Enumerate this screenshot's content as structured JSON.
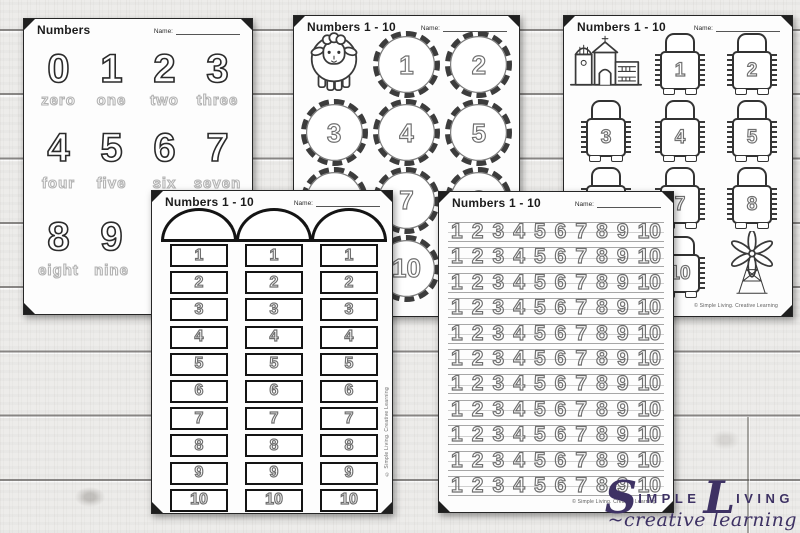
{
  "colors": {
    "logo_purple": "#3e3264",
    "paper": "#fdfdfd",
    "ink": "#2b2b2b",
    "traced_gray": "#6f6f6f"
  },
  "sheets": {
    "numbers_words": {
      "title": "Numbers",
      "name_label": "Name:",
      "rows": [
        {
          "digits": [
            "0",
            "1",
            "2",
            "3"
          ],
          "words": [
            "zero",
            "one",
            "two",
            "three"
          ]
        },
        {
          "digits": [
            "4",
            "5",
            "6",
            "7"
          ],
          "words": [
            "four",
            "five",
            "six",
            "seven"
          ]
        },
        {
          "digits": [
            "8",
            "9"
          ],
          "words": [
            "eight",
            "nine"
          ]
        }
      ]
    },
    "sheep_circles": {
      "title": "Numbers 1 - 10",
      "name_label": "Name:",
      "icon": "sheep",
      "numbers": [
        "1",
        "2",
        "3",
        "4",
        "5",
        "6",
        "7",
        "8",
        "9",
        "10"
      ]
    },
    "tractors": {
      "title": "Numbers 1 - 10",
      "name_label": "Name:",
      "icons": [
        "farmhouse",
        "windmill"
      ],
      "numbers": [
        "1",
        "2",
        "3",
        "4",
        "5",
        "6",
        "7",
        "8",
        "9",
        "10"
      ],
      "copyright": "© Simple Living. Creative Learning"
    },
    "silos": {
      "title": "Numbers 1 - 10",
      "name_label": "Name:",
      "numbers": [
        "1",
        "2",
        "3",
        "4",
        "5",
        "6",
        "7",
        "8",
        "9",
        "10"
      ],
      "copyright": "© Simple Living. Creative Learning"
    },
    "number_lines": {
      "title": "Numbers 1 - 10",
      "name_label": "Name:",
      "rows": 11,
      "row_numbers": [
        "1",
        "2",
        "3",
        "4",
        "5",
        "6",
        "7",
        "8",
        "9",
        "10"
      ],
      "copyright": "© Simple Living. Creative Learning"
    }
  },
  "logo": {
    "word1_initial": "S",
    "word1_rest": "IMPLE",
    "word2_initial": "L",
    "word2_rest": "IVING",
    "tagline": "~creative learning"
  }
}
